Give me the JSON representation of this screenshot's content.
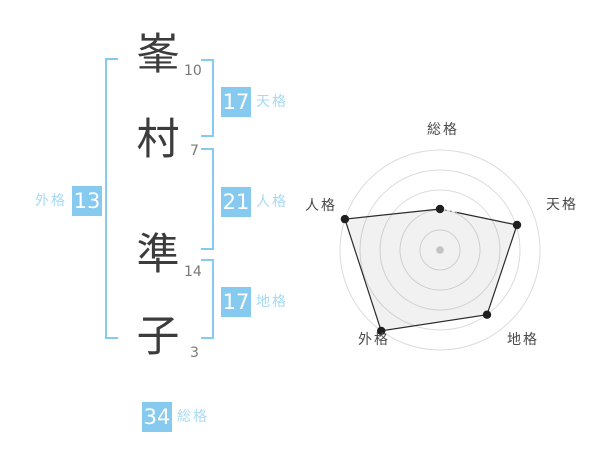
{
  "name_analysis": {
    "characters": [
      {
        "char": "峯",
        "strokes": "10"
      },
      {
        "char": "村",
        "strokes": "7"
      },
      {
        "char": "準",
        "strokes": "14"
      },
      {
        "char": "子",
        "strokes": "3"
      }
    ],
    "results": {
      "tenkaku": {
        "value": "17",
        "label": "天格"
      },
      "jinkaku": {
        "value": "21",
        "label": "人格"
      },
      "chikaku": {
        "value": "17",
        "label": "地格"
      },
      "gaikaku": {
        "value": "13",
        "label": "外格"
      },
      "soukaku": {
        "value": "34",
        "label": "総格"
      }
    },
    "style": {
      "accent_blue": "#87caef",
      "label_blue": "#a6d9f6",
      "kanji_color": "#3c3c3c",
      "stroke_count_color": "#787878"
    }
  },
  "chart_data": {
    "type": "radar",
    "categories": [
      "総格",
      "天格",
      "地格",
      "外格",
      "人格"
    ],
    "category_keys": [
      "soukaku",
      "tenkaku",
      "chikaku",
      "gaikaku",
      "jinkaku"
    ],
    "values": [
      41,
      81,
      80,
      100,
      100
    ],
    "max": 100,
    "rings": 5,
    "grid_on": true,
    "grid_color": "#dcdcdc",
    "line_color": "#2b2b2b",
    "fill_color": "rgba(0,0,0,0.055)",
    "point_color": "#1f1f1f",
    "center_dot_color": "#c3c3c3",
    "label_color": "#4a4a4a",
    "legend_position": "none",
    "title": ""
  }
}
